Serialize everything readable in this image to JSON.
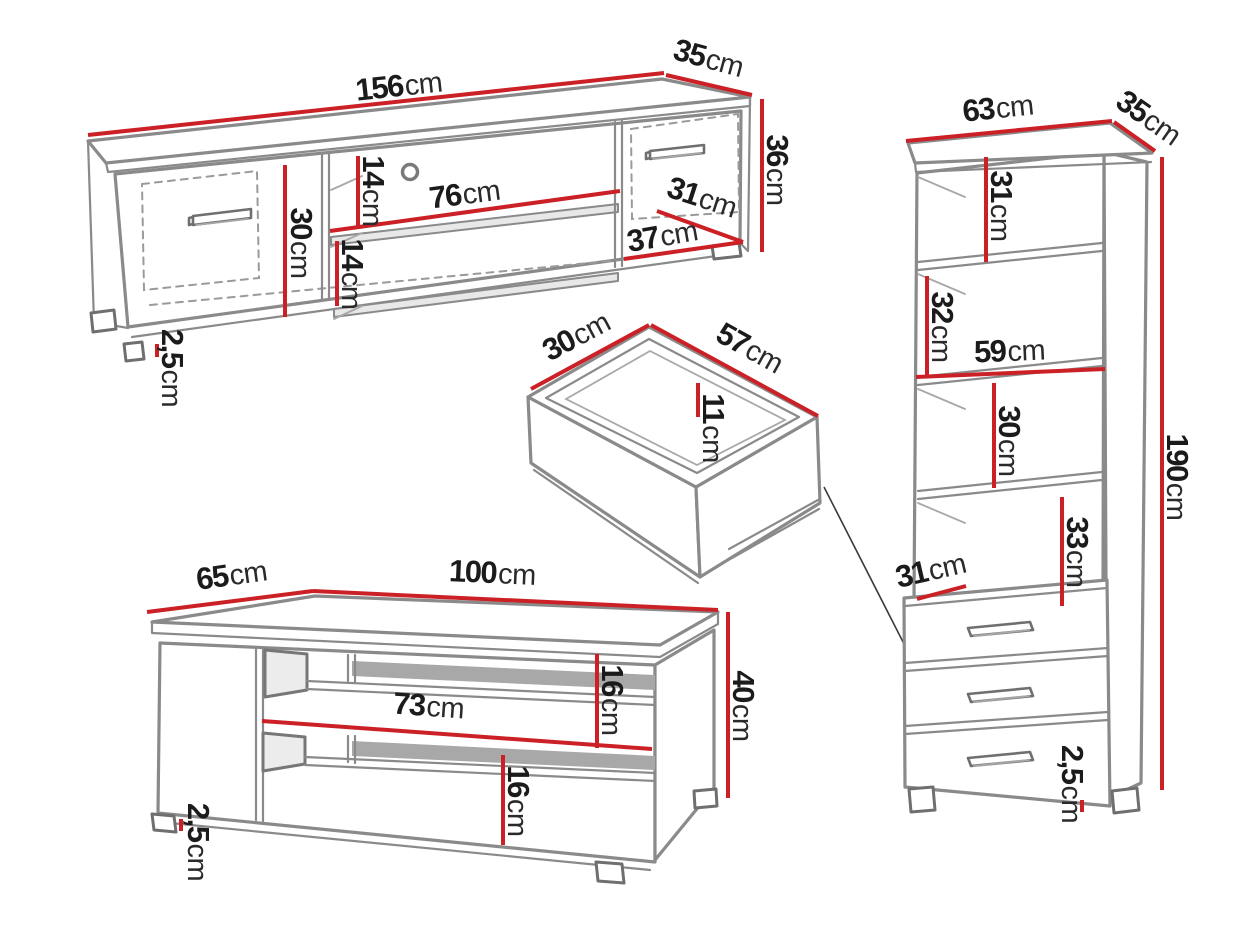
{
  "unit": "cm",
  "title": "furniture-dimensions-diagram",
  "colors": {
    "dimension_red": "#cb2026",
    "outline_gray": "#8a8a8a",
    "text_black": "#1b1b1b"
  },
  "dims": {
    "tv": {
      "width": "156",
      "depth": "35",
      "height": "36",
      "interior_height": "30",
      "top_shelf_height": "14",
      "shelf_width": "76",
      "bottom_shelf_height": "14",
      "end_door_top": "31",
      "end_door_bottom": "37",
      "leg_height": "2,5"
    },
    "drawer": {
      "depth": "30",
      "width": "57",
      "height": "11"
    },
    "table": {
      "depth": "65",
      "width": "100",
      "shelf_width": "73",
      "upper_opening_height": "16",
      "lower_opening_height": "16",
      "height": "40",
      "leg_height": "2,5"
    },
    "cabinet": {
      "width": "63",
      "depth": "35",
      "opening_1_height": "31",
      "opening_2_height": "32",
      "shelf_width": "59",
      "opening_3_height": "30",
      "opening_4_height": "33",
      "drawer_top_depth": "31",
      "height": "190",
      "leg_height": "2,5"
    }
  }
}
